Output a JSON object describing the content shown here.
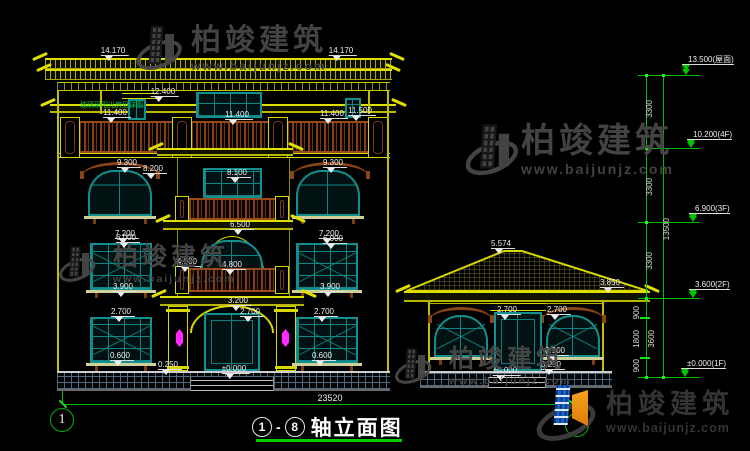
{
  "title": {
    "axis_start": "1",
    "axis_end": "8",
    "dash": "-",
    "text": "轴立面图"
  },
  "axis_bubble_left": "1",
  "watermark": {
    "brand": "柏竣建筑",
    "url": "www.baijunjz.com"
  },
  "logo": {
    "brand": "柏竣建筑",
    "url": "www.baijunjz.com"
  },
  "colors": {
    "cad_line_yellow": "#e0e000",
    "window_teal": "#129090",
    "trim_brown": "#8a4516",
    "dimension_green": "#00c400",
    "lamp_magenta": "#ff2bff",
    "logo_blue": "#1a63c8",
    "logo_orange": "#f09010",
    "title_underline_green": "#00cc00"
  },
  "annotations": [
    {
      "k": "dim",
      "t": "14.170",
      "x": 113,
      "y": 46
    },
    {
      "k": "dim",
      "t": "14.170",
      "x": 341,
      "y": 46
    },
    {
      "k": "dim",
      "t": "12.400",
      "x": 163,
      "y": 87
    },
    {
      "k": "note",
      "t": "玻璃采阳光房见详图",
      "x": 80,
      "y": 100
    },
    {
      "k": "dim",
      "t": "11.400",
      "x": 115,
      "y": 108
    },
    {
      "k": "dim",
      "t": "11.400",
      "x": 237,
      "y": 110
    },
    {
      "k": "dim",
      "t": "11.400",
      "x": 332,
      "y": 109
    },
    {
      "k": "dim",
      "t": "11.500",
      "x": 360,
      "y": 106
    },
    {
      "k": "dim",
      "t": "9.300",
      "x": 127,
      "y": 158
    },
    {
      "k": "dim",
      "t": "9.300",
      "x": 333,
      "y": 158
    },
    {
      "k": "dim",
      "t": "8.200",
      "x": 153,
      "y": 164
    },
    {
      "k": "dim",
      "t": "8.100",
      "x": 237,
      "y": 168
    },
    {
      "k": "dim",
      "t": "7.200",
      "x": 125,
      "y": 229
    },
    {
      "k": "dim",
      "t": "7.200",
      "x": 329,
      "y": 229
    },
    {
      "k": "dim",
      "t": "6.500",
      "x": 240,
      "y": 220
    },
    {
      "k": "dim",
      "t": "6.000",
      "x": 126,
      "y": 233
    },
    {
      "k": "dim",
      "t": "6.000",
      "x": 333,
      "y": 234
    },
    {
      "k": "dim",
      "t": "4.900",
      "x": 187,
      "y": 257
    },
    {
      "k": "dim",
      "t": "4.800",
      "x": 232,
      "y": 260
    },
    {
      "k": "dim",
      "t": "3.900",
      "x": 123,
      "y": 282
    },
    {
      "k": "dim",
      "t": "3.900",
      "x": 330,
      "y": 282
    },
    {
      "k": "dim",
      "t": "3.200",
      "x": 238,
      "y": 296
    },
    {
      "k": "dim",
      "t": "2.700",
      "x": 121,
      "y": 307
    },
    {
      "k": "dim",
      "t": "2.700",
      "x": 250,
      "y": 307
    },
    {
      "k": "dim",
      "t": "2.700",
      "x": 324,
      "y": 307
    },
    {
      "k": "dim",
      "t": "0.600",
      "x": 120,
      "y": 351
    },
    {
      "k": "dim",
      "t": "0.600",
      "x": 322,
      "y": 351
    },
    {
      "k": "dim",
      "t": "0.250",
      "x": 168,
      "y": 360
    },
    {
      "k": "dim",
      "t": "±0.000",
      "x": 234,
      "y": 364
    },
    {
      "k": "dim",
      "t": "5.574",
      "x": 501,
      "y": 239
    },
    {
      "k": "dim",
      "t": "3.850",
      "x": 610,
      "y": 278
    },
    {
      "k": "dim",
      "t": "2.700",
      "x": 507,
      "y": 305
    },
    {
      "k": "dim",
      "t": "2.700",
      "x": 557,
      "y": 305
    },
    {
      "k": "dim",
      "t": "0.900",
      "x": 555,
      "y": 346
    },
    {
      "k": "dim",
      "t": "0.250",
      "x": 551,
      "y": 360
    },
    {
      "k": "dim",
      "t": "±0.000",
      "x": 505,
      "y": 366
    },
    {
      "k": "plain",
      "t": "23520",
      "x": 330,
      "y": 393
    },
    {
      "k": "flag",
      "t": "13.500(屋面)",
      "x": 688,
      "y": 55
    },
    {
      "k": "flag",
      "t": "10.200(4F)",
      "x": 693,
      "y": 130
    },
    {
      "k": "flag",
      "t": "6.900(3F)",
      "x": 695,
      "y": 204
    },
    {
      "k": "flag",
      "t": "3.600(2F)",
      "x": 695,
      "y": 280
    },
    {
      "k": "flag",
      "t": "±0.000(1F)",
      "x": 687,
      "y": 359
    },
    {
      "k": "vdim",
      "t": "3300",
      "x": 645,
      "y": 100
    },
    {
      "k": "vdim",
      "t": "3300",
      "x": 645,
      "y": 178
    },
    {
      "k": "vdim",
      "t": "3300",
      "x": 645,
      "y": 252
    },
    {
      "k": "vdim",
      "t": "13500",
      "x": 662,
      "y": 218
    },
    {
      "k": "vdim",
      "t": "900",
      "x": 632,
      "y": 306
    },
    {
      "k": "vdim",
      "t": "1800",
      "x": 632,
      "y": 330
    },
    {
      "k": "vdim",
      "t": "900",
      "x": 632,
      "y": 359
    },
    {
      "k": "vdim",
      "t": "3600",
      "x": 647,
      "y": 330
    }
  ]
}
